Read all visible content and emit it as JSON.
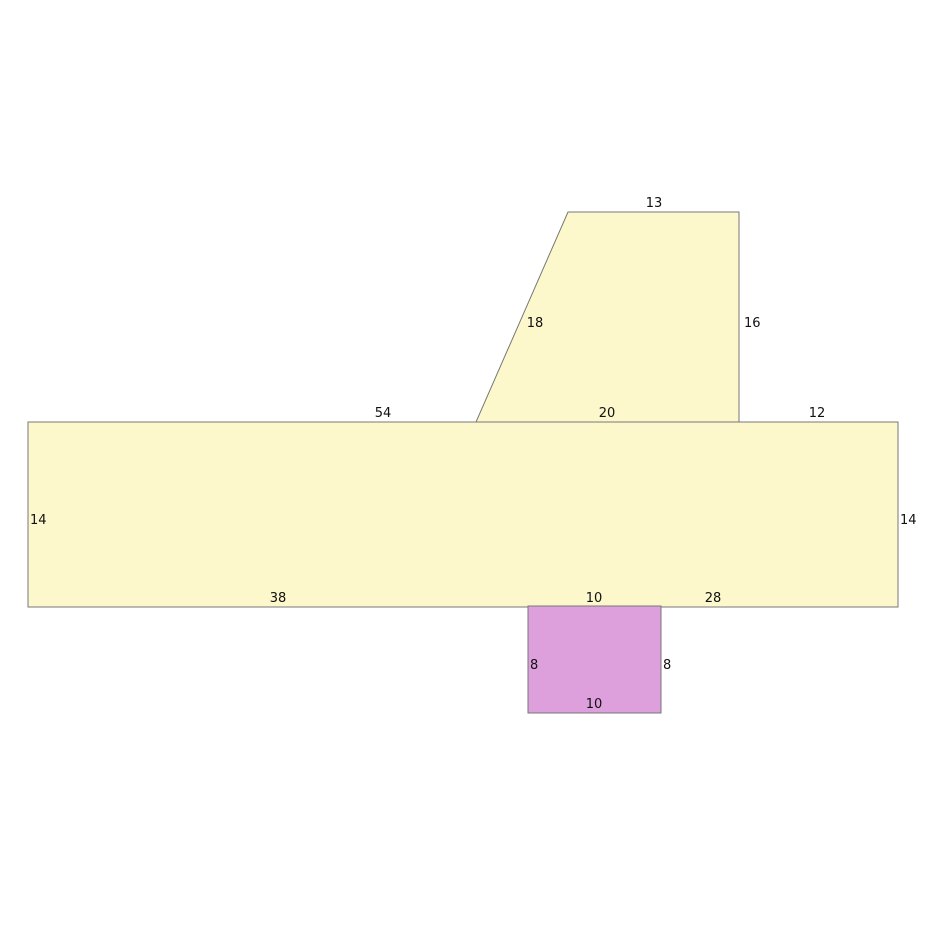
{
  "figure": {
    "description": "Composite geometry figure with labeled side lengths",
    "background_color": "#ffffff",
    "stroke_color": "#777777",
    "text_color": "#111111",
    "trapezoid": {
      "fill": "#fcf8cc",
      "labels": {
        "top": "13",
        "left_slant": "18",
        "right": "16"
      }
    },
    "rectangle": {
      "fill": "#fcf8cc",
      "top_segments": [
        "54",
        "20",
        "12"
      ],
      "left": "14",
      "right": "14",
      "bottom_segments": [
        "38",
        "10",
        "28"
      ]
    },
    "square": {
      "fill": "#dda0dd",
      "labels": {
        "top": "10",
        "left": "8",
        "right": "8",
        "bottom": "10"
      }
    }
  }
}
